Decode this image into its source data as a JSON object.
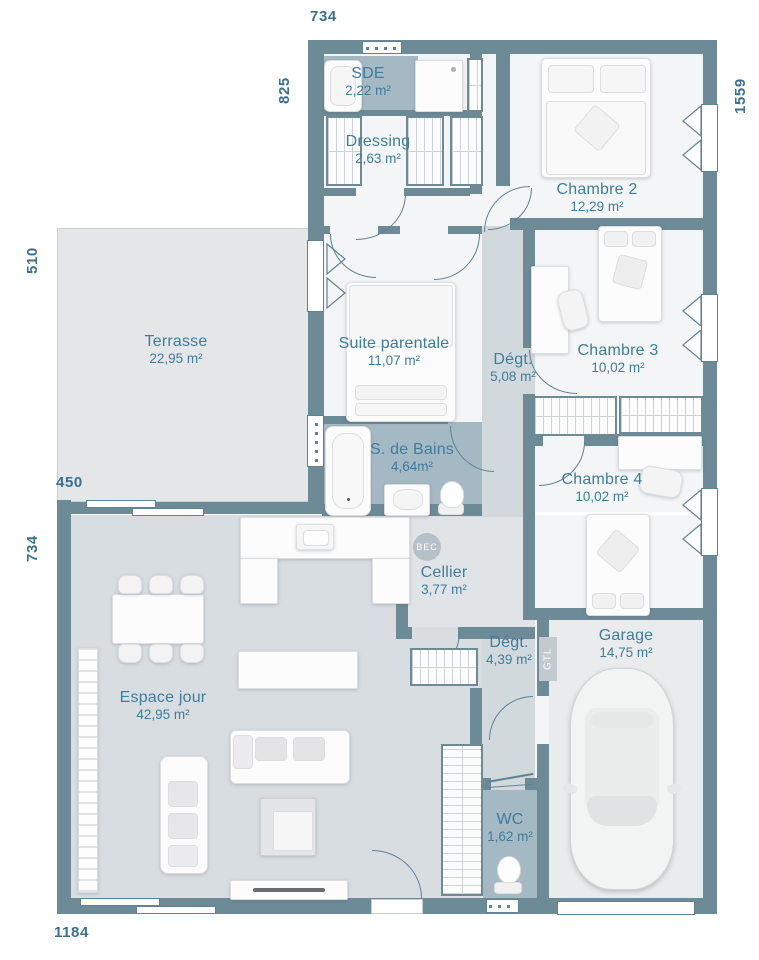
{
  "title": "floor-plan",
  "dimensions": {
    "top": "734",
    "left_upper": "825",
    "right": "1559",
    "left_terrace": "510",
    "terrace_bottom": "450",
    "left_lower": "734",
    "bottom": "1184"
  },
  "rooms": [
    {
      "id": "sde",
      "name": "SDE",
      "area": "2,22 m²"
    },
    {
      "id": "dressing",
      "name": "Dressing",
      "area": "2,63 m²"
    },
    {
      "id": "chambre2",
      "name": "Chambre 2",
      "area": "12,29 m²"
    },
    {
      "id": "terrasse",
      "name": "Terrasse",
      "area": "22,95 m²"
    },
    {
      "id": "suite",
      "name": "Suite parentale",
      "area": "11,07 m²"
    },
    {
      "id": "degt1",
      "name": "Dégt.",
      "area": "5,08 m²"
    },
    {
      "id": "chambre3",
      "name": "Chambre 3",
      "area": "10,02 m²"
    },
    {
      "id": "sdb",
      "name": "S. de Bains",
      "area": "4,64m²"
    },
    {
      "id": "chambre4",
      "name": "Chambre 4",
      "area": "10,02 m²"
    },
    {
      "id": "cellier",
      "name": "Cellier",
      "area": "3,77 m²"
    },
    {
      "id": "espace",
      "name": "Espace jour",
      "area": "42,95 m²"
    },
    {
      "id": "degt2",
      "name": "Dégt.",
      "area": "4,39 m²"
    },
    {
      "id": "garage",
      "name": "Garage",
      "area": "14,75 m²"
    },
    {
      "id": "wc",
      "name": "WC",
      "area": "1,62 m²"
    }
  ],
  "annotations": {
    "bec": "BEC",
    "gtl": "GTL"
  },
  "colors": {
    "wall": "#6d8a97",
    "room_text": "#3f7d9d",
    "dim_text": "#3a7192",
    "wet_room": "#a5b9c4",
    "corridor": "#d2d9dd",
    "living": "#d8dde1",
    "terrace": "#e4e6e8",
    "garage": "#e9ebec",
    "room": "#f4f5f6"
  }
}
